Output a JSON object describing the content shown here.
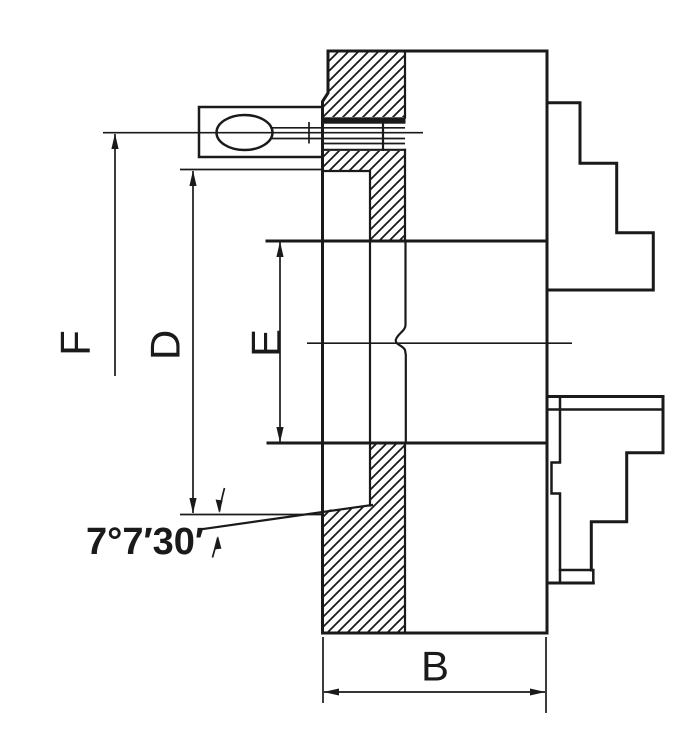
{
  "drawing": {
    "ink_color": "#1a1a1a",
    "background_color": "#ffffff",
    "labels": {
      "f_dim": "F",
      "d_dim": "D",
      "e_dim": "E",
      "b_dim": "B",
      "taper_angle": "7°7′30′"
    }
  }
}
